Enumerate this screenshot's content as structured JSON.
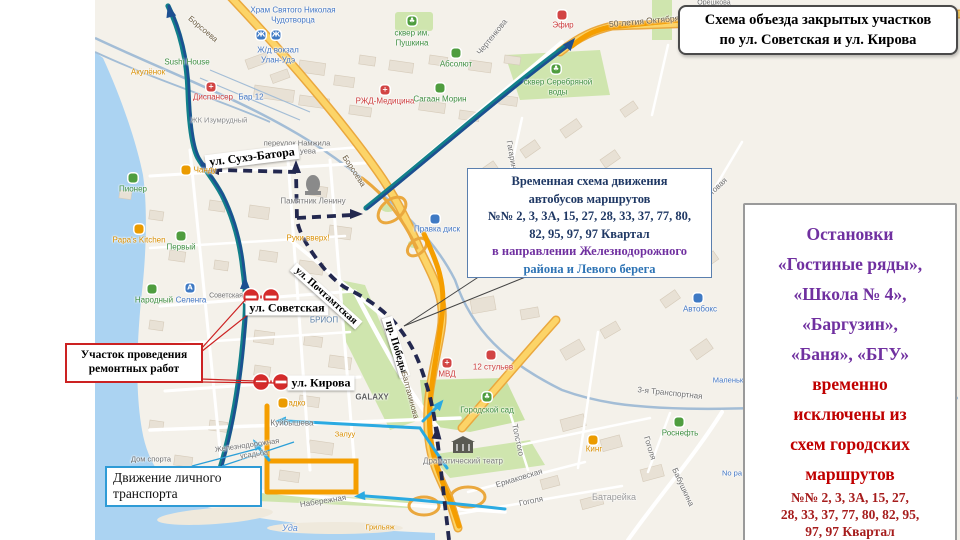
{
  "title_box": {
    "line1": "Схема объезда закрытых участков",
    "line2": "по ул. Советская и ул. Кирова"
  },
  "temp_scheme_box": {
    "lines": [
      {
        "text": "Временная схема движения",
        "color": "#1f3864"
      },
      {
        "text": "автобусов маршрутов",
        "color": "#1f3864"
      },
      {
        "text": "№№ 2, 3, 3А, 15, 27, 28, 33, 37, 77, 80,",
        "color": "#1f3864"
      },
      {
        "text": "82, 95, 97, 97 Квартал",
        "color": "#1f3864"
      },
      {
        "text": "в направлении Железнодорожного",
        "color": "#7030a0"
      },
      {
        "text": "района и Левого берега",
        "color": "#2e74b5"
      }
    ]
  },
  "stops_panel": {
    "big_lines": [
      {
        "text": "Остановки",
        "color": "#7030a0"
      },
      {
        "text": "«Гостиные ряды»,",
        "color": "#7030a0"
      },
      {
        "text": "«Школа № 4»,",
        "color": "#7030a0"
      },
      {
        "text": "«Баргузин»,",
        "color": "#7030a0"
      },
      {
        "text": "«Баня», «БГУ»",
        "color": "#7030a0"
      },
      {
        "text": "временно",
        "color": "#c00000"
      },
      {
        "text": "исключены из",
        "color": "#c00000"
      },
      {
        "text": "схем городских",
        "color": "#c00000"
      },
      {
        "text": "маршрутов",
        "color": "#c00000"
      }
    ],
    "small_lines": [
      "№№ 2, 3, 3А, 15, 27,",
      "28, 33, 37, 77, 80, 82, 95,",
      "97, 97 Квартал"
    ],
    "small_color": "#a61c1c"
  },
  "works_box": {
    "line1": "Участок проведения",
    "line2": "ремонтных работ",
    "color": "#cc2222"
  },
  "transport_box": {
    "line1": "Движение личного",
    "line2": "транспорта"
  },
  "legend_colors": {
    "bus_detour_orange": "#f59e00",
    "temp_scheme_dashed_navy": "#23284f",
    "bus_route_blue": "#1d4f91",
    "personal_transport_cyan": "#2aaae2",
    "road_closed_red": "#d42b2b"
  },
  "map": {
    "labels": [
      {
        "t": "Храм Святого Николая",
        "x": 293,
        "y": 10,
        "c": "#4276c4"
      },
      {
        "t": "Чудотворца",
        "x": 293,
        "y": 20,
        "c": "#4276c4"
      },
      {
        "t": "Ж/д вокзал",
        "x": 278,
        "y": 50,
        "c": "#4276c4"
      },
      {
        "t": "Улан-Удэ",
        "x": 278,
        "y": 60,
        "c": "#4276c4"
      },
      {
        "t": "Sushi House",
        "x": 187,
        "y": 62,
        "c": "#3e8e41"
      },
      {
        "t": "Акулёнок",
        "x": 148,
        "y": 72,
        "c": "#d98e00"
      },
      {
        "t": "Диспансер",
        "x": 213,
        "y": 97,
        "c": "#cc3b3b"
      },
      {
        "t": "Бар 12",
        "x": 251,
        "y": 97,
        "c": "#4276c4"
      },
      {
        "t": "ЖК Изумрудный",
        "x": 219,
        "y": 120,
        "c": "#8a8a8a",
        "s": 7.5
      },
      {
        "t": "сквер им.",
        "x": 412,
        "y": 33,
        "c": "#3e8e41"
      },
      {
        "t": "Пушкина",
        "x": 412,
        "y": 43,
        "c": "#3e8e41"
      },
      {
        "t": "РЖД-Медицина",
        "x": 385,
        "y": 101,
        "c": "#cc3b3b"
      },
      {
        "t": "Сагаан Морин",
        "x": 440,
        "y": 99,
        "c": "#3e8e41"
      },
      {
        "t": "Абсолют",
        "x": 456,
        "y": 64,
        "c": "#3e8e41"
      },
      {
        "t": "Борсоева",
        "x": 203,
        "y": 29,
        "c": "#6b5b3f",
        "r": 40
      },
      {
        "t": "Борсоева",
        "x": 354,
        "y": 171,
        "c": "#6b5b3f",
        "r": 57
      },
      {
        "t": "Чертенкова",
        "x": 492,
        "y": 37,
        "r": -51
      },
      {
        "t": "50-летия Октября",
        "x": 644,
        "y": 21,
        "c": "#6b5b3f",
        "s": 8.5,
        "r": -5
      },
      {
        "t": "Эфир",
        "x": 563,
        "y": 25,
        "c": "#cc3b3b"
      },
      {
        "t": "сквер Серебряной",
        "x": 558,
        "y": 82,
        "c": "#3e8e41"
      },
      {
        "t": "воды",
        "x": 558,
        "y": 92,
        "c": "#3e8e41"
      },
      {
        "t": "переулок Намжила",
        "x": 297,
        "y": 143,
        "s": 7.5
      },
      {
        "t": "уева",
        "x": 308,
        "y": 151,
        "s": 7.5
      },
      {
        "t": "Гагарина",
        "x": 512,
        "y": 157,
        "r": 80
      },
      {
        "t": "ул. Сухэ-Батора",
        "x": 252,
        "y": 157,
        "box": 1,
        "s": 12,
        "r": -7
      },
      {
        "t": "Памятник Ленину",
        "x": 313,
        "y": 201,
        "c": "#7a7a7a"
      },
      {
        "t": "Чанду",
        "x": 205,
        "y": 170,
        "c": "#d98e00"
      },
      {
        "t": "Руки вверх!",
        "x": 308,
        "y": 238,
        "c": "#d98e00"
      },
      {
        "t": "Пионер",
        "x": 133,
        "y": 189,
        "c": "#3e8e41"
      },
      {
        "t": "Papa's Kitchen",
        "x": 139,
        "y": 240,
        "c": "#d98e00"
      },
      {
        "t": "Первый",
        "x": 181,
        "y": 247,
        "c": "#3e8e41"
      },
      {
        "t": "Народный",
        "x": 154,
        "y": 300,
        "c": "#3e8e41"
      },
      {
        "t": "Селенга",
        "x": 191,
        "y": 300,
        "c": "#4276c4"
      },
      {
        "t": "Советская",
        "x": 226,
        "y": 296,
        "s": 7
      },
      {
        "t": "ул. Советская",
        "x": 287,
        "y": 308,
        "box": 1,
        "s": 12
      },
      {
        "t": "ул. Кирова",
        "x": 321,
        "y": 383,
        "box": 1,
        "s": 12
      },
      {
        "t": "ул. Почтамтская",
        "x": 326,
        "y": 296,
        "box": 1,
        "s": 10.5,
        "r": 42
      },
      {
        "t": "пр. Победы",
        "x": 396,
        "y": 347,
        "box": 1,
        "s": 10.5,
        "r": 73
      },
      {
        "t": "БРИОП",
        "x": 324,
        "y": 320,
        "c": "#5b7fa6"
      },
      {
        "t": "GALAXY",
        "x": 372,
        "y": 397,
        "c": "#5f5f5f",
        "b": 1
      },
      {
        "t": "Садко",
        "x": 294,
        "y": 403,
        "c": "#d98e00"
      },
      {
        "t": "Правка диск",
        "x": 437,
        "y": 229,
        "c": "#4276c4"
      },
      {
        "t": "МВД",
        "x": 447,
        "y": 374,
        "c": "#cc3b3b"
      },
      {
        "t": "12 стульев",
        "x": 493,
        "y": 367,
        "c": "#cc3b3b"
      },
      {
        "t": "Городской сад",
        "x": 487,
        "y": 410,
        "c": "#3e8e41"
      },
      {
        "t": "Балтахинова",
        "x": 410,
        "y": 395,
        "c": "#6b5b3f",
        "r": 75
      },
      {
        "t": "Куйбышева",
        "x": 292,
        "y": 423
      },
      {
        "t": "Железнодорожная",
        "x": 247,
        "y": 445,
        "r": -8,
        "s": 7.5
      },
      {
        "t": "усадьба",
        "x": 254,
        "y": 454,
        "r": -8,
        "s": 7.5
      },
      {
        "t": "Дом спорта",
        "x": 151,
        "y": 459,
        "s": 7.5
      },
      {
        "t": "Залуу",
        "x": 345,
        "y": 434,
        "c": "#d98e00",
        "s": 7.5
      },
      {
        "t": "Набережная",
        "x": 323,
        "y": 501,
        "r": -9
      },
      {
        "t": "Уда",
        "x": 290,
        "y": 528,
        "c": "#5b8ed6",
        "s": 9,
        "i": 1
      },
      {
        "t": "Грильяж",
        "x": 380,
        "y": 527,
        "c": "#d98e00",
        "s": 7.5
      },
      {
        "t": "Драматический театр",
        "x": 463,
        "y": 461,
        "c": "#7a7a7a"
      },
      {
        "t": "Толстого",
        "x": 518,
        "y": 440,
        "r": 78
      },
      {
        "t": "Ермаковская",
        "x": 519,
        "y": 478,
        "r": -17
      },
      {
        "t": "Гоголя",
        "x": 531,
        "y": 501,
        "r": -12
      },
      {
        "t": "Гоголя",
        "x": 650,
        "y": 448,
        "r": 73
      },
      {
        "t": "Батарейка",
        "x": 614,
        "y": 497,
        "c": "#9a9a9a",
        "s": 9
      },
      {
        "t": "3-я Транспортная",
        "x": 670,
        "y": 393,
        "r": 6
      },
      {
        "t": "Бабушкина",
        "x": 683,
        "y": 487,
        "r": 65
      },
      {
        "t": "Роснефть",
        "x": 680,
        "y": 433,
        "c": "#3e8e41"
      },
      {
        "t": "Кинг",
        "x": 594,
        "y": 449,
        "c": "#d98e00"
      },
      {
        "t": "Автобокс",
        "x": 700,
        "y": 309,
        "c": "#4276c4"
      },
      {
        "t": "Маленьк",
        "x": 728,
        "y": 380,
        "c": "#4276c4",
        "s": 7.5
      },
      {
        "t": "No pa",
        "x": 732,
        "y": 473,
        "c": "#4276c4",
        "s": 7.5
      },
      {
        "t": "Трактовая",
        "x": 712,
        "y": 192,
        "r": -43
      },
      {
        "t": "Орешкова",
        "x": 714,
        "y": 3,
        "s": 7
      }
    ],
    "icons": [
      {
        "x": 412,
        "y": 21,
        "c": "#4f9d3f",
        "g": "♣",
        "n": "tree-icon"
      },
      {
        "x": 556,
        "y": 69,
        "c": "#4f9d3f",
        "g": "♣",
        "n": "tree-icon"
      },
      {
        "x": 487,
        "y": 397,
        "c": "#4f9d3f",
        "g": "♣",
        "n": "tree-icon"
      },
      {
        "x": 261,
        "y": 35,
        "c": "#3f7ac4",
        "g": "Ж",
        "n": "train-station-icon"
      },
      {
        "x": 276,
        "y": 35,
        "c": "#3f7ac4",
        "g": "Ж",
        "n": "train-station-icon"
      },
      {
        "x": 190,
        "y": 288,
        "c": "#3f7ac4",
        "g": "A",
        "n": "bus-station-icon"
      },
      {
        "x": 385,
        "y": 90,
        "c": "#d24444",
        "g": "+",
        "n": "medical-icon"
      },
      {
        "x": 211,
        "y": 87,
        "c": "#d24444",
        "g": "+",
        "n": "medical-icon"
      },
      {
        "x": 447,
        "y": 363,
        "c": "#d24444",
        "g": "+",
        "n": "police-icon"
      },
      {
        "x": 133,
        "y": 178,
        "c": "#4f9d3f",
        "g": "",
        "n": "poi-icon"
      },
      {
        "x": 181,
        "y": 236,
        "c": "#4f9d3f",
        "g": "",
        "n": "poi-icon"
      },
      {
        "x": 152,
        "y": 289,
        "c": "#4f9d3f",
        "g": "",
        "n": "poi-icon"
      },
      {
        "x": 440,
        "y": 88,
        "c": "#4f9d3f",
        "g": "",
        "n": "poi-icon"
      },
      {
        "x": 679,
        "y": 422,
        "c": "#4f9d3f",
        "g": "",
        "n": "poi-icon"
      },
      {
        "x": 456,
        "y": 53,
        "c": "#4f9d3f",
        "g": "",
        "n": "poi-icon"
      },
      {
        "x": 139,
        "y": 229,
        "c": "#eb9b00",
        "g": "",
        "n": "food-icon"
      },
      {
        "x": 186,
        "y": 170,
        "c": "#eb9b00",
        "g": "",
        "n": "food-icon"
      },
      {
        "x": 593,
        "y": 440,
        "c": "#eb9b00",
        "g": "",
        "n": "food-icon"
      },
      {
        "x": 283,
        "y": 403,
        "c": "#eb9b00",
        "g": "",
        "n": "food-icon"
      },
      {
        "x": 562,
        "y": 15,
        "c": "#d24444",
        "g": "",
        "n": "food-icon"
      },
      {
        "x": 491,
        "y": 355,
        "c": "#d24444",
        "g": "",
        "n": "food-icon"
      },
      {
        "x": 698,
        "y": 298,
        "c": "#3f7ac4",
        "g": "",
        "n": "service-icon"
      },
      {
        "x": 435,
        "y": 219,
        "c": "#3f7ac4",
        "g": "",
        "n": "service-icon"
      }
    ]
  }
}
